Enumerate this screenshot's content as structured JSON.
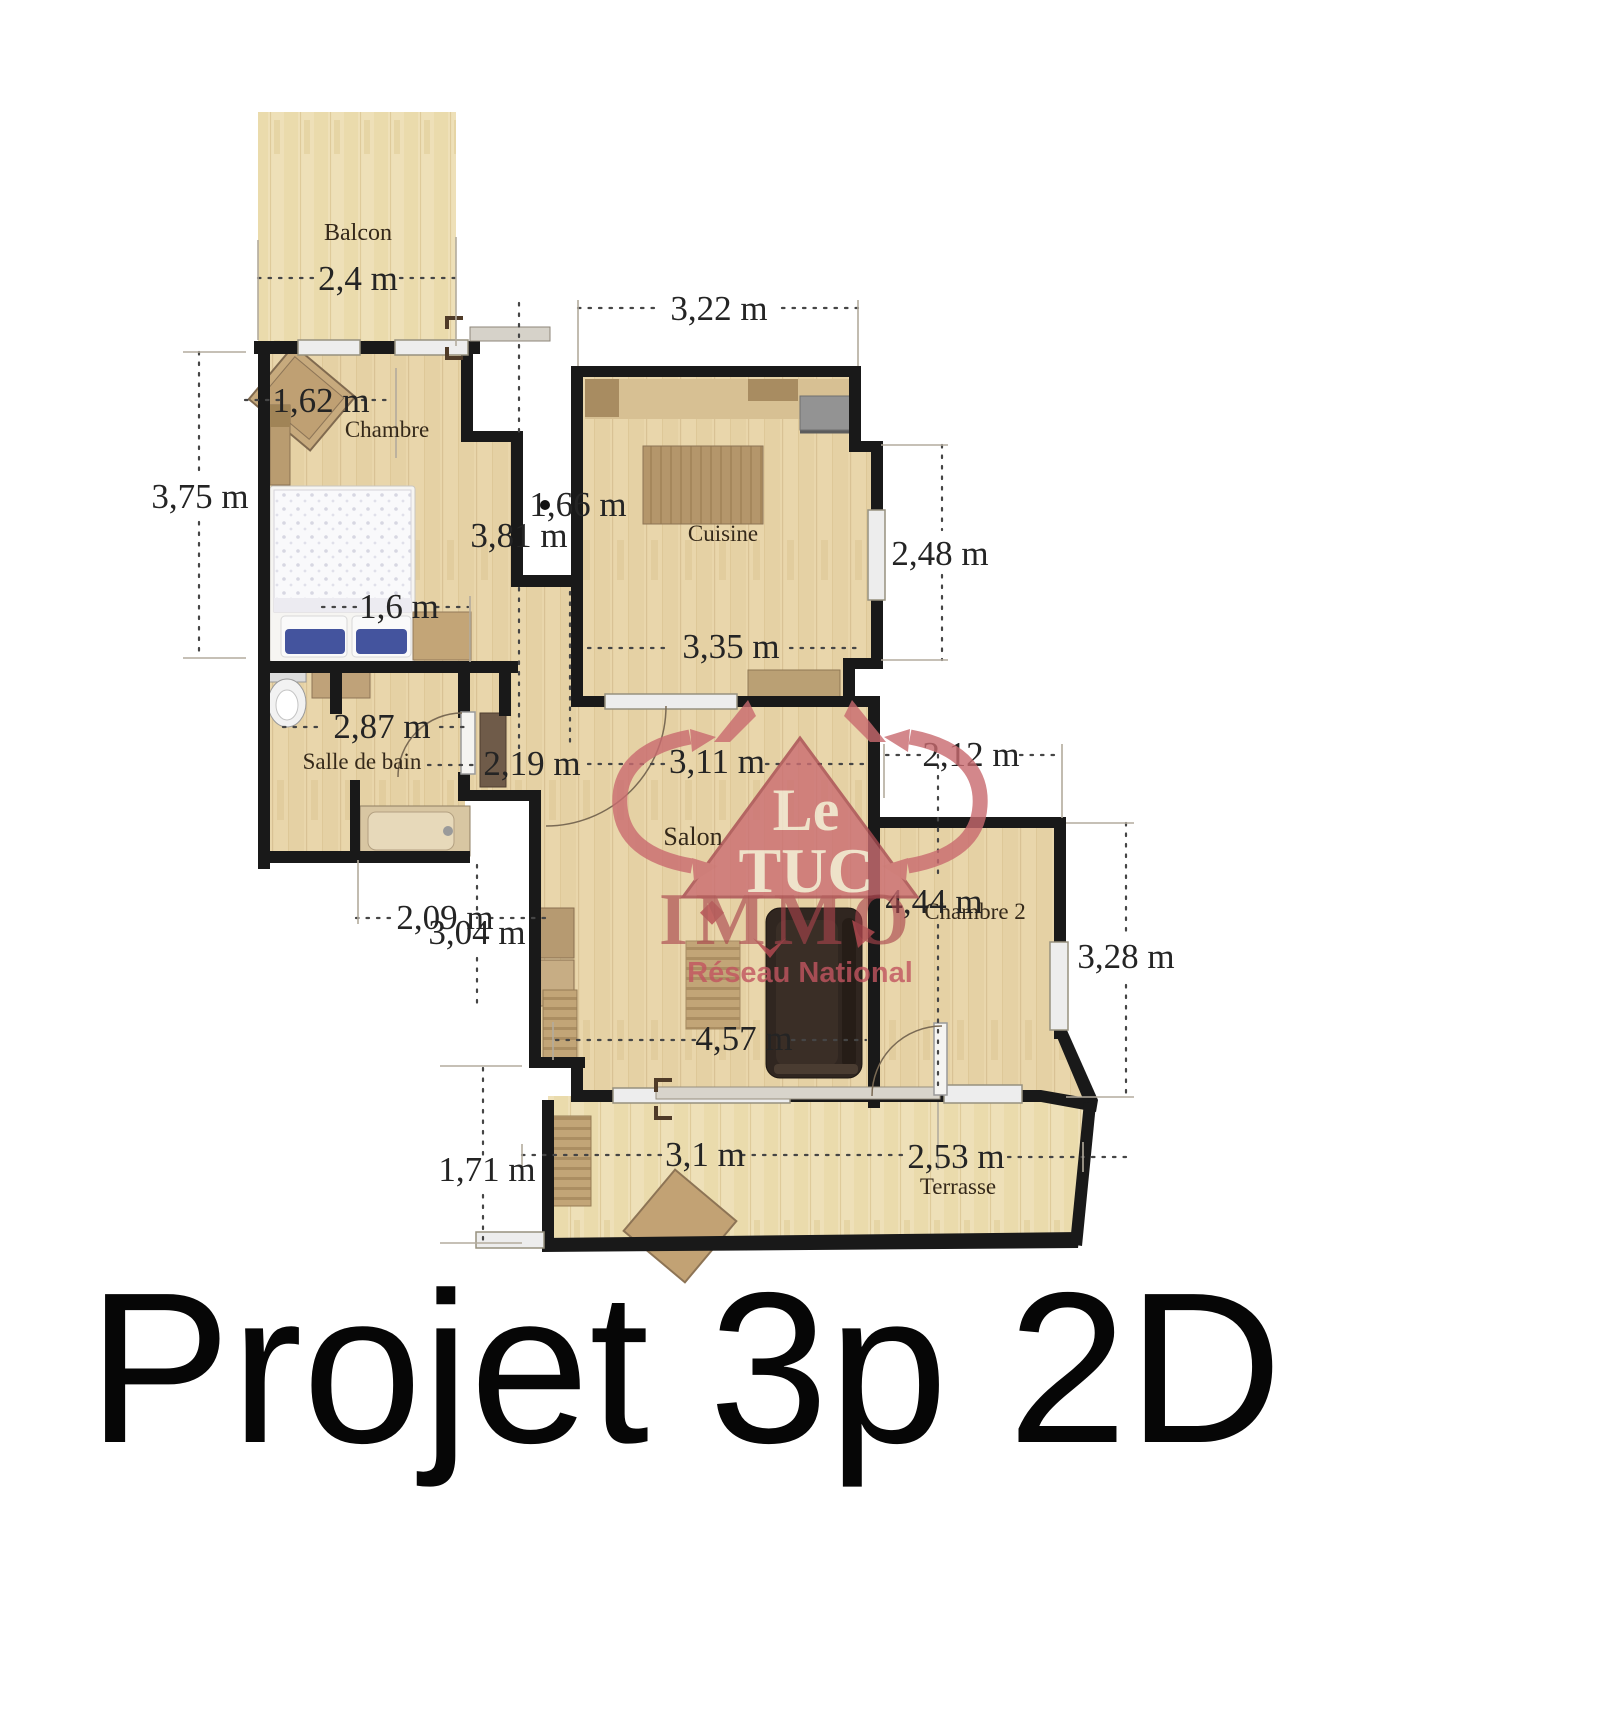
{
  "title": "Projet 3p 2D",
  "watermark": {
    "line1": "Le",
    "line2": "TUC",
    "line3": "IMMO",
    "line4": "Réseau National",
    "color": "#c96a6f"
  },
  "colors": {
    "floor_indoor": "#e9d6ab",
    "floor_outdoor": "#eee0b8",
    "wall": "#191919",
    "dimension_text": "#242424"
  },
  "rooms": {
    "balcon": "Balcon",
    "chambre": "Chambre",
    "cuisine": "Cuisine",
    "salle_de_bain": "Salle de bain",
    "salon": "Salon",
    "chambre2": "Chambre 2",
    "terrasse": "Terrasse"
  },
  "dimensions": {
    "balcon_width": "2,4 m",
    "chambre_top": "1,62 m",
    "chambre_left": "3,75 m",
    "bed_width": "1,6 m",
    "cuisine_top": "3,22 m",
    "gap_height": "1,66 m",
    "chambre_height": "3,81 m",
    "cuisine_right": "2,48 m",
    "cuisine_bottom": "3,35 m",
    "sdb_width": "2,87 m",
    "hall_width": "2,19 m",
    "salon_top": "3,11 m",
    "chambre2_top": "2,12 m",
    "sdb_bottom": "2,09 m",
    "salon_left": "3,04 m",
    "chambre2_height": "4,44 m",
    "chambre2_right": "3,28 m",
    "salon_width": "4,57 m",
    "terrasse_left": "1,71 m",
    "terrasse_w1": "3,1 m",
    "terrasse_w2": "2,53 m"
  }
}
